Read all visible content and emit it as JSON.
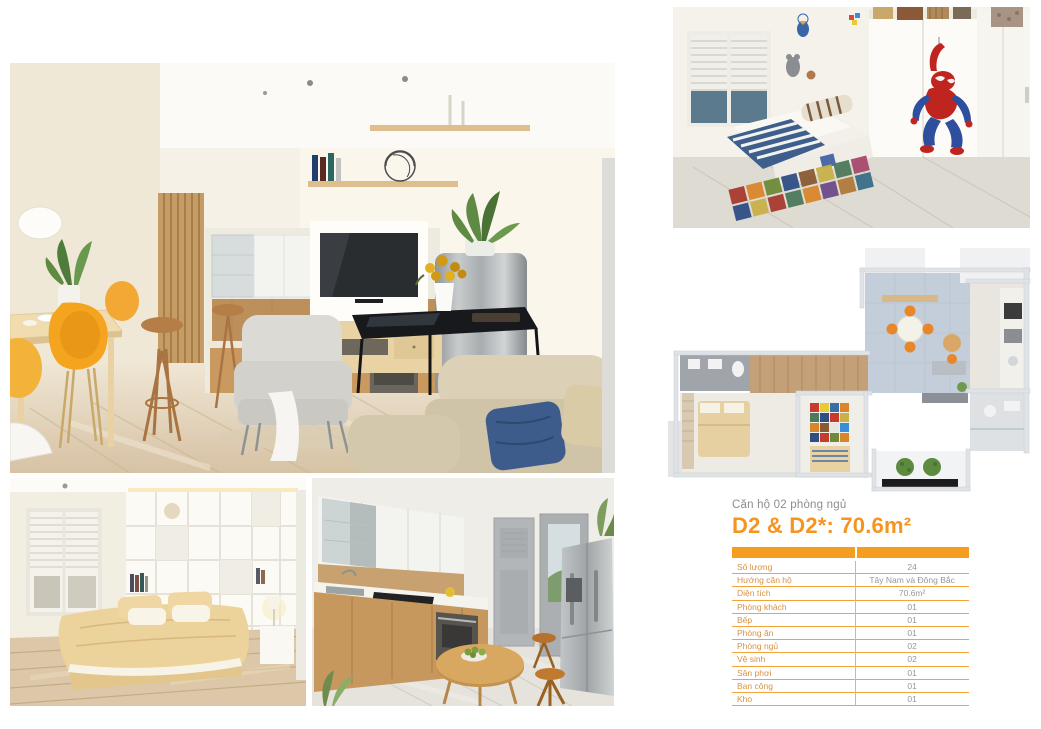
{
  "page": {
    "subtitle": "Căn hộ 02 phòng ngủ",
    "title": "D2 & D2*: 70.6m²",
    "accent_color": "#f5941f",
    "table_rule_color": "#f2a33b"
  },
  "images": {
    "living_room": "living-dining-kitchen-render",
    "master_bedroom": "master-bedroom-render",
    "kitchen": "kitchen-render",
    "kids_bedroom": "kids-bedroom-spiderman-render",
    "floor_plan": "apartment-3d-floorplan-render"
  },
  "spec_table": {
    "rows": [
      {
        "label": "Số lượng",
        "value": "24"
      },
      {
        "label": "Hướng căn hộ",
        "value": "Tây Nam và Đông Bắc"
      },
      {
        "label": "Diện tích",
        "value": "70.6m²"
      },
      {
        "label": "Phòng khách",
        "value": "01"
      },
      {
        "label": "Bếp",
        "value": "01"
      },
      {
        "label": "Phòng ăn",
        "value": "01"
      },
      {
        "label": "Phòng ngủ",
        "value": "02"
      },
      {
        "label": "Vệ sinh",
        "value": "02"
      },
      {
        "label": "Sân phơi",
        "value": "01"
      },
      {
        "label": "Ban công",
        "value": "01"
      },
      {
        "label": "Kho",
        "value": "01"
      }
    ]
  }
}
